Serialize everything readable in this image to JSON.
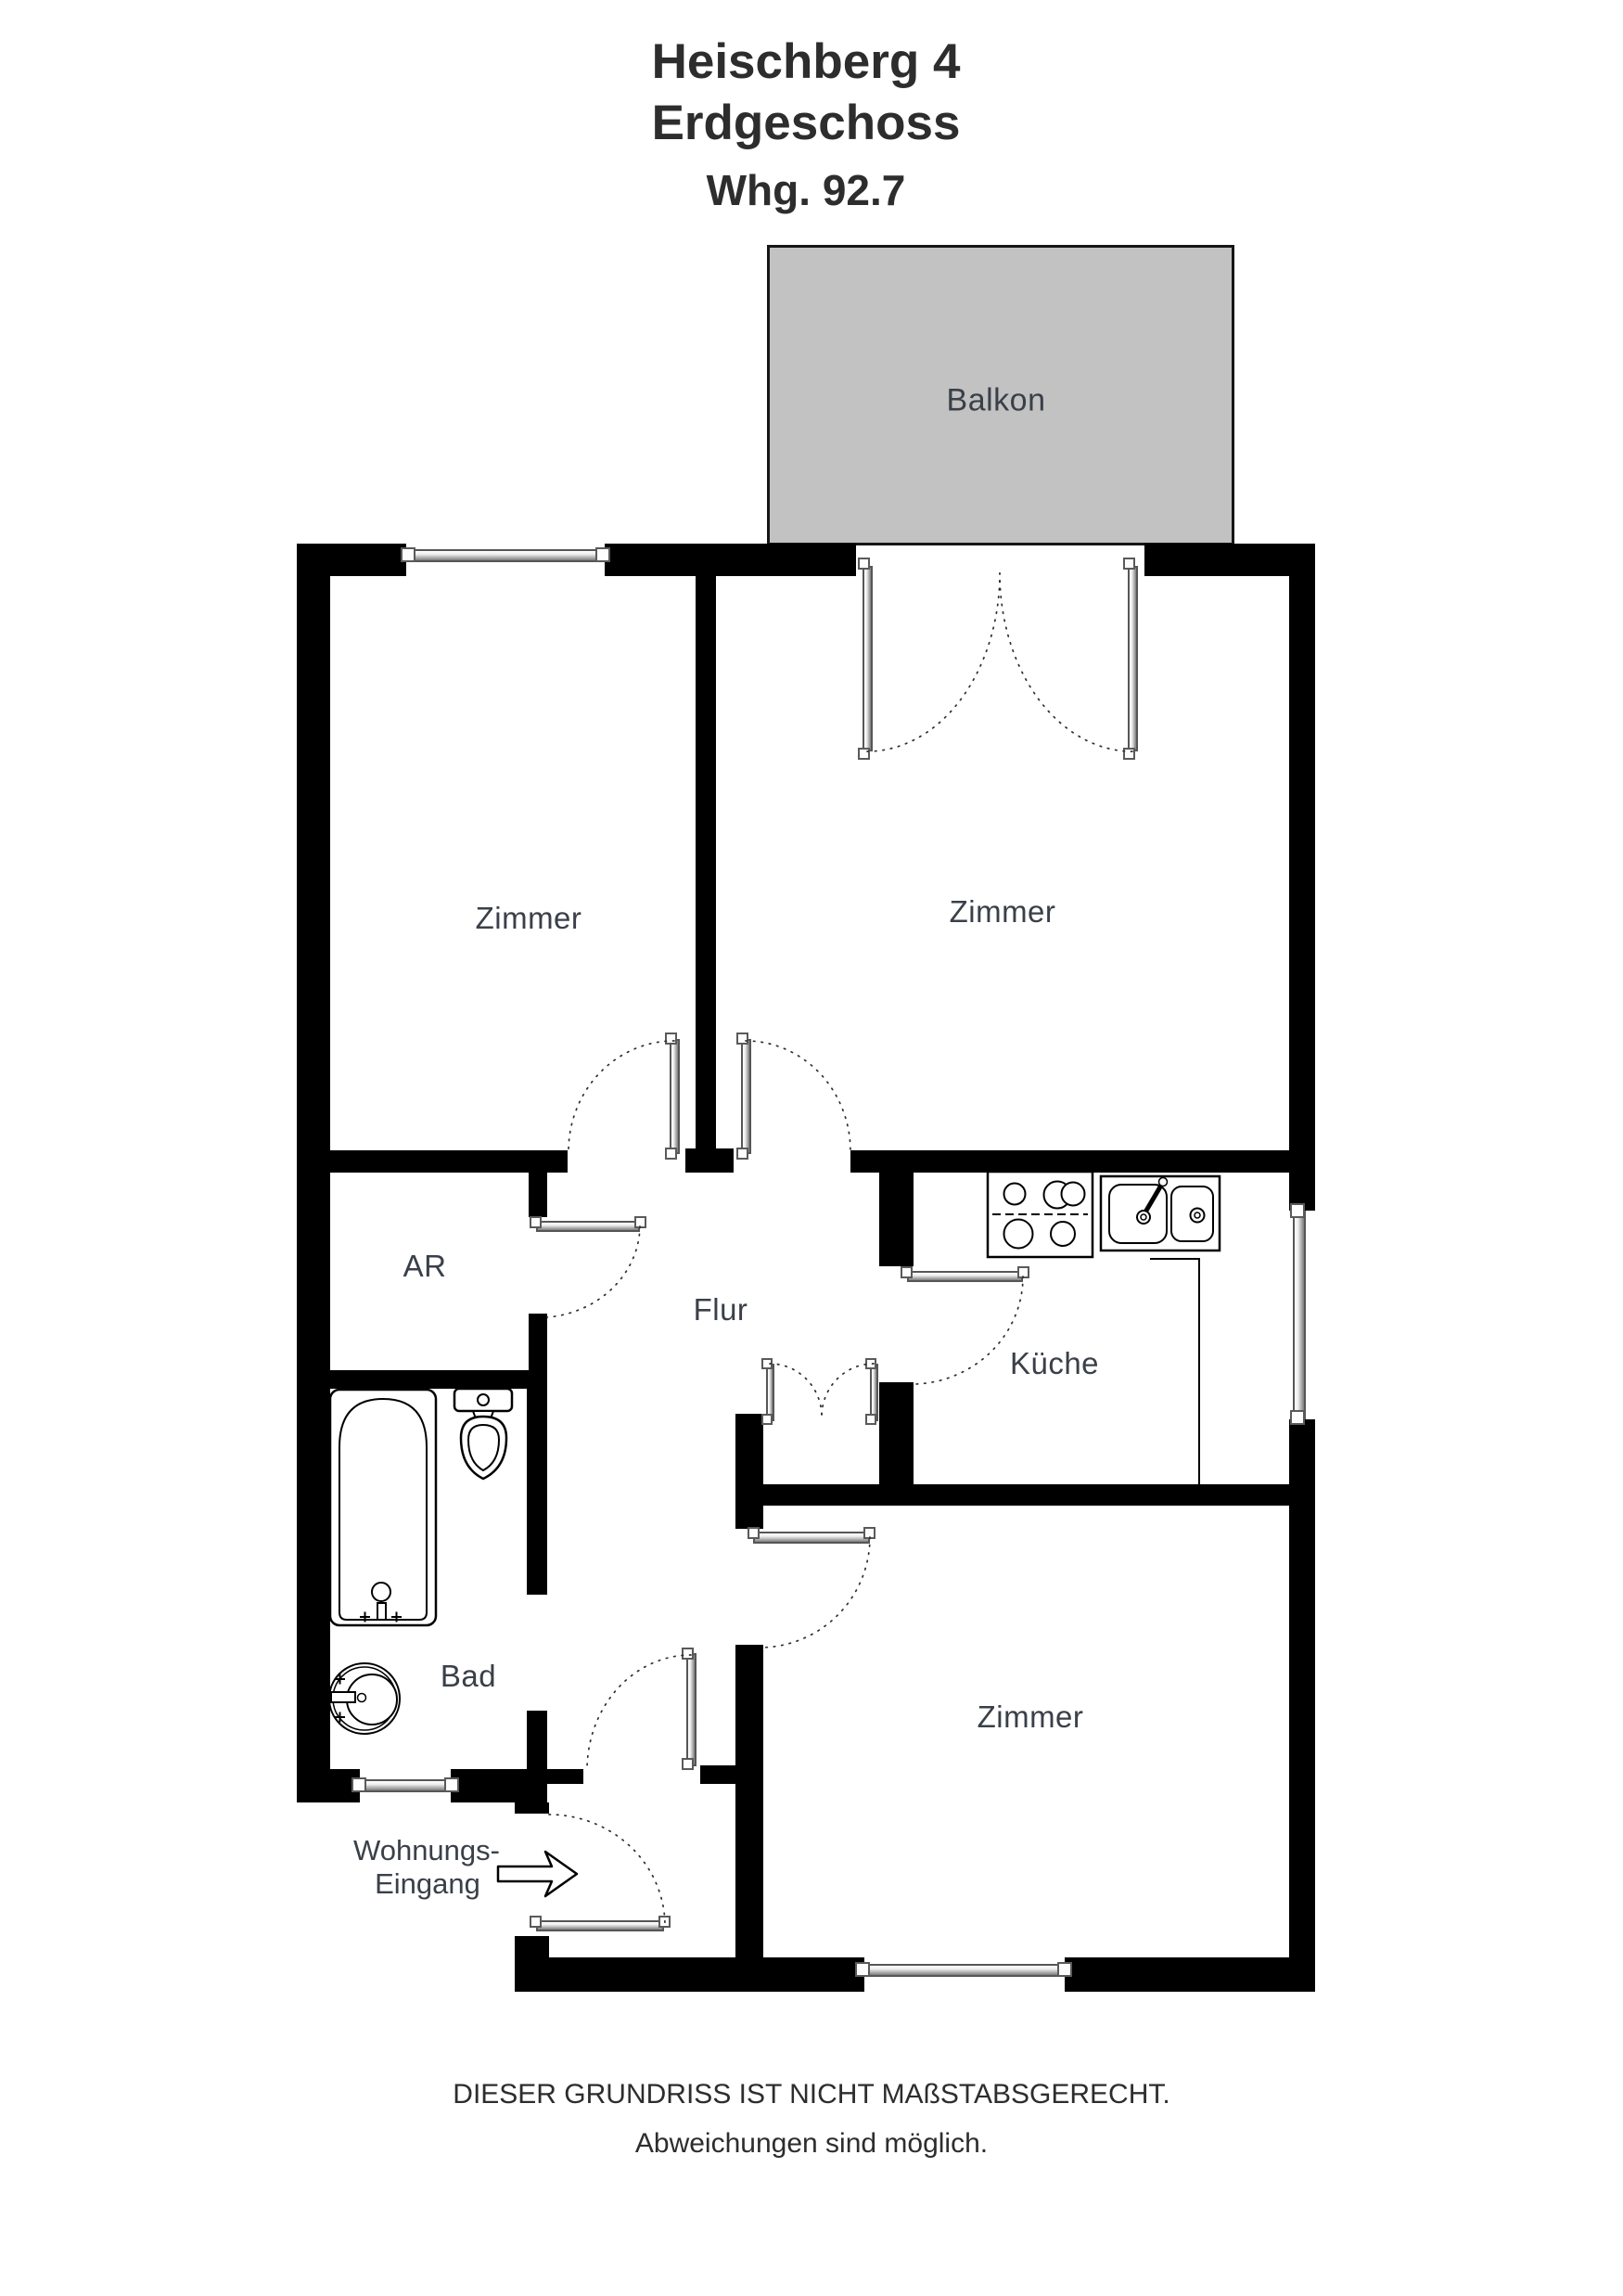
{
  "title": {
    "building": "Heischberg 4",
    "floor": "Erdgeschoss",
    "unit": "Whg. 92.7"
  },
  "room_labels": {
    "balcony": "Balkon",
    "bedroom_top_left": "Zimmer",
    "bedroom_top_right": "Zimmer",
    "storage_room": "AR",
    "hallway": "Flur",
    "kitchen": "Küche",
    "bathroom": "Bad",
    "bedroom_bottom": "Zimmer"
  },
  "entrance_label": {
    "line1": "Wohnungs-",
    "line2": "Eingang"
  },
  "footer": {
    "line1": "DIESER GRUNDRISS IST NICHT MAßSTABSGERECHT.",
    "line2": "Abweichungen sind möglich."
  },
  "colors": {
    "wall": "#000000",
    "balcony": "#c2c2c2",
    "label": "#3a4049",
    "title": "#2d2d2d"
  }
}
